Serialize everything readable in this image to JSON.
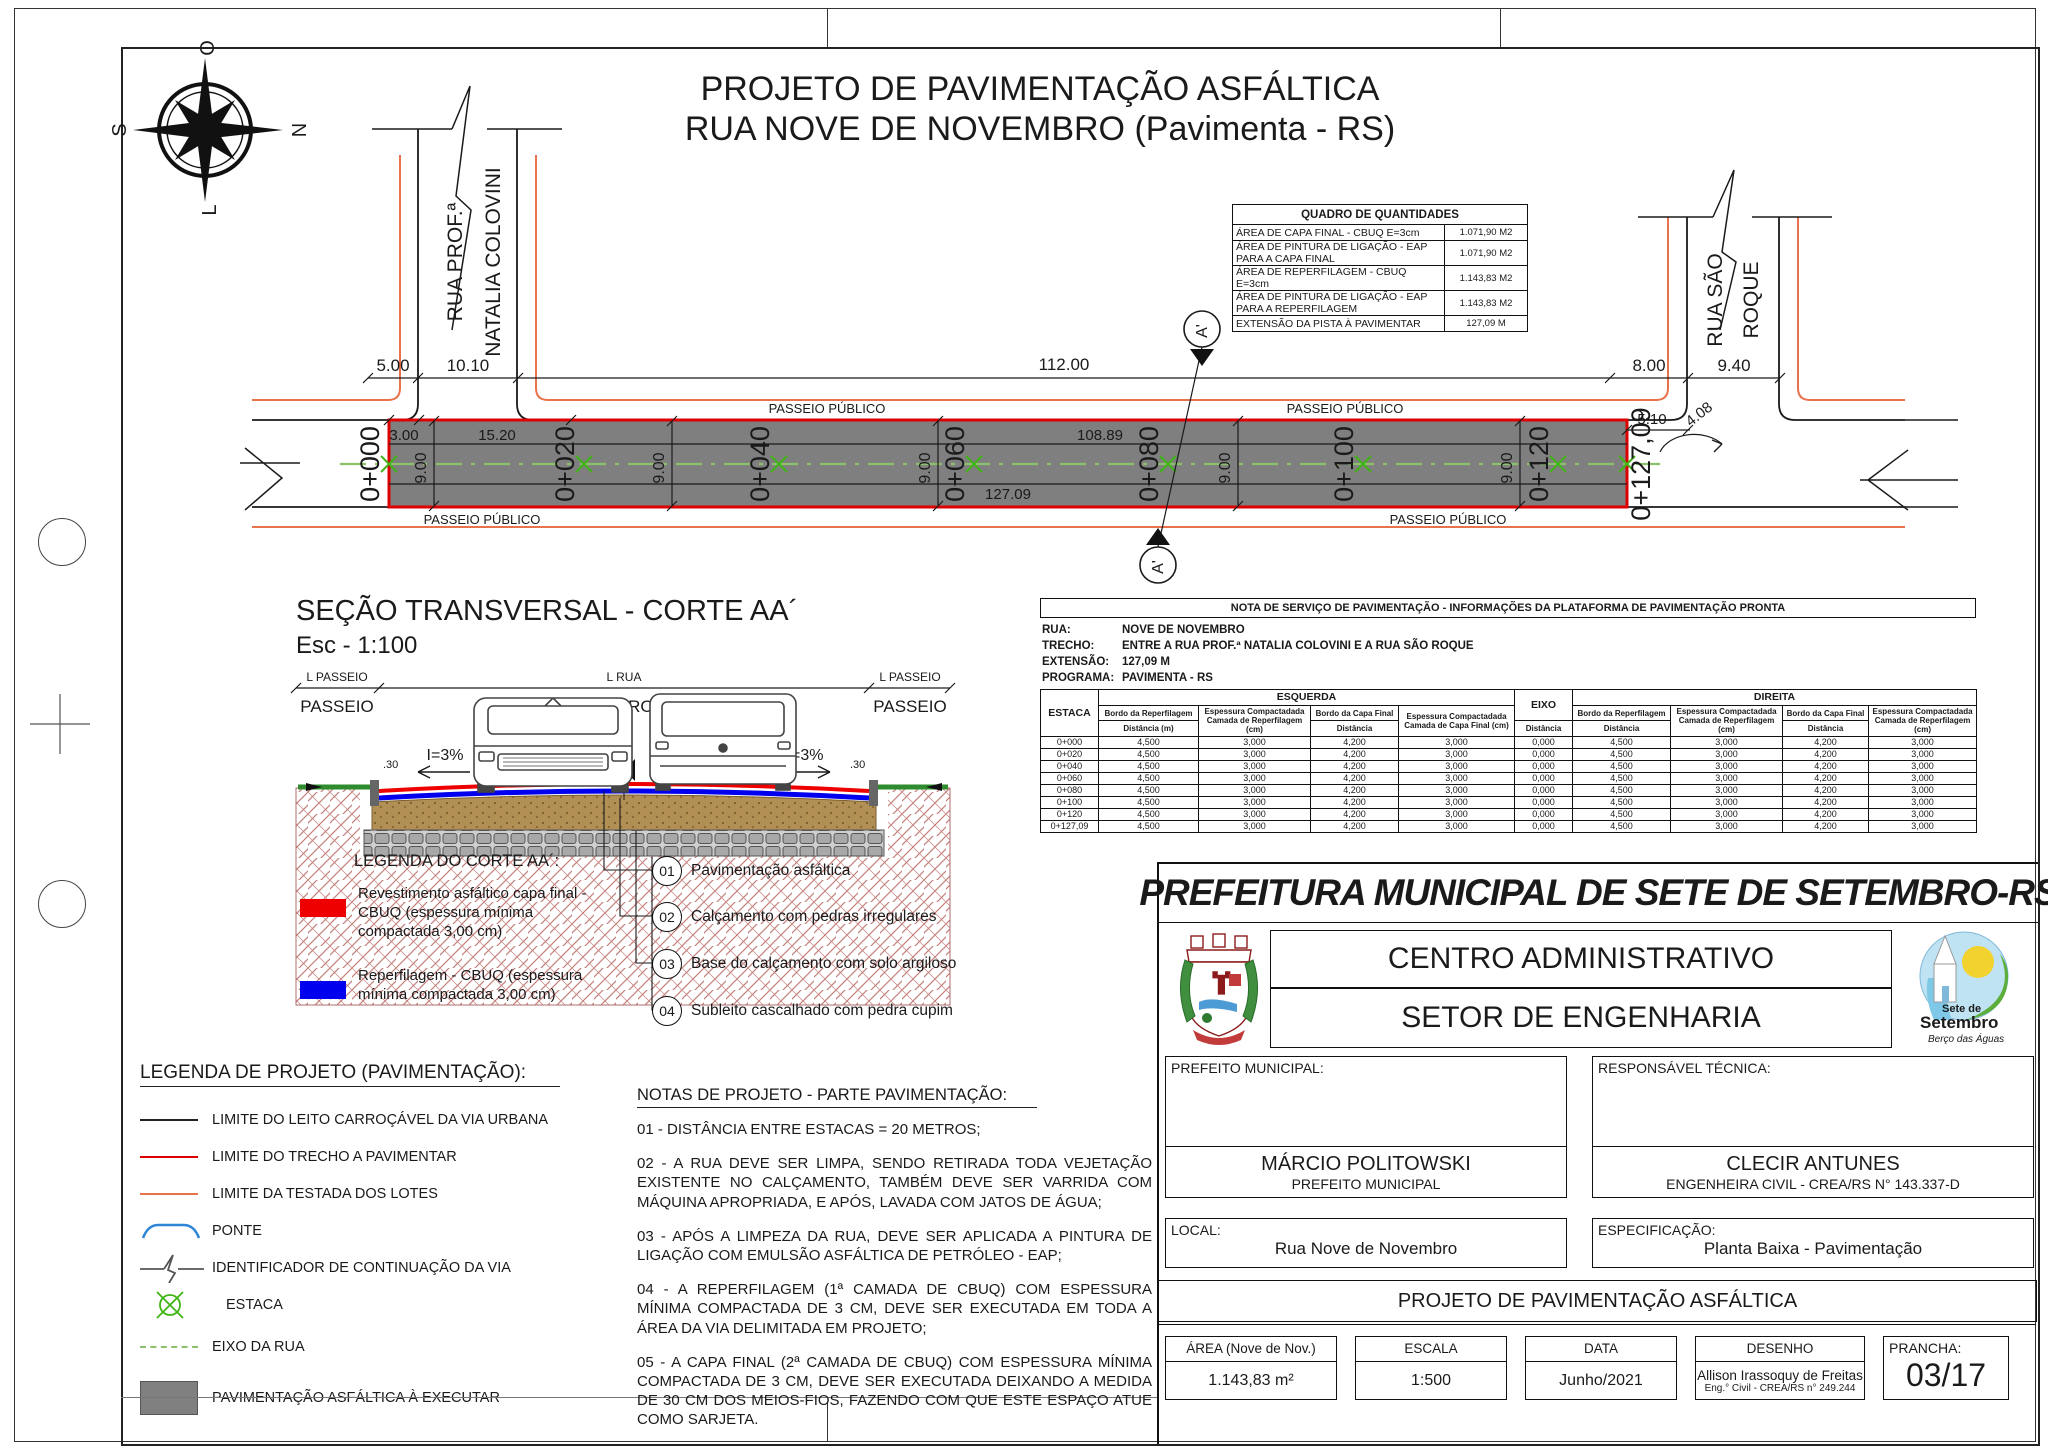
{
  "sheet": {
    "title_line1": "PROJETO DE PAVIMENTAÇÃO ASFÁLTICA",
    "title_line2": "RUA NOVE DE NOVEMBRO (Pavimenta - RS)"
  },
  "compass": {
    "n": "N",
    "s": "S",
    "o": "O",
    "l": "L"
  },
  "plan": {
    "street_left_line1": "RUA PROF.ª",
    "street_left_line2": "NATALIA COLOVINI",
    "street_right_line1": "RUA SÃO",
    "street_right_line2": "ROQUE",
    "passeio": "PASSEIO PÚBLICO",
    "stations": [
      "0+000",
      "0+020",
      "0+040",
      "0+060",
      "0+080",
      "0+100",
      "0+120",
      "0+127,09"
    ],
    "dims": {
      "d5": "5.00",
      "d1010": "10.10",
      "d112": "112.00",
      "d8": "8.00",
      "d940": "9.40",
      "d3": "3.00",
      "d1520": "15.20",
      "d10889": "108.89",
      "d12709": "127.09",
      "d510": "5.10",
      "d408": "4.08",
      "d9": "9.00"
    },
    "section_mark": "A'"
  },
  "quadro": {
    "title": "QUADRO DE QUANTIDADES",
    "rows": [
      [
        "ÁREA DE CAPA FINAL - CBUQ E=3cm",
        "1.071,90 M2"
      ],
      [
        "ÁREA DE PINTURA DE LIGAÇÃO - EAP PARA A CAPA FINAL",
        "1.071,90 M2"
      ],
      [
        "ÁREA DE REPERFILAGEM - CBUQ E=3cm",
        "1.143,83 M2"
      ],
      [
        "ÁREA DE PINTURA DE LIGAÇÃO - EAP PARA A REPERFILAGEM",
        "1.143,83 M2"
      ],
      [
        "EXTENSÃO DA PISTA À PAVIMENTAR",
        "127,09 M"
      ]
    ]
  },
  "section": {
    "title": "SEÇÃO TRANSVERSAL - CORTE AA´",
    "scale": "Esc - 1:100",
    "lim_passeio": "L PASSEIO",
    "lim_rua": "L RUA",
    "passeio": "PASSEIO",
    "leito": "LEITO CARROÇÁVEL",
    "slope": "I=3%",
    "offset": ".30",
    "eixo": "EIXO",
    "legend_title": "LEGENDA DO CORTE AA´:",
    "legend_red": "Revestimento asfáltico capa final - CBUQ (espessura mínima compactada 3,00 cm)",
    "legend_blue": "Reperfilagem - CBUQ (espessura mínima compactada 3,00 cm)",
    "callouts": [
      {
        "num": "01",
        "text": "Pavimentação asfáltica"
      },
      {
        "num": "02",
        "text": "Calçamento com pedras irregulares"
      },
      {
        "num": "03",
        "text": "Base do calçamento com solo argiloso"
      },
      {
        "num": "04",
        "text": "Subleito cascalhado com pedra cupim"
      }
    ]
  },
  "service_note": {
    "title": "NOTA DE SERVIÇO DE PAVIMENTAÇÃO - INFORMAÇÕES DA PLATAFORMA DE PAVIMENTAÇÃO PRONTA",
    "info": [
      [
        "RUA:",
        "NOVE DE NOVEMBRO"
      ],
      [
        "TRECHO:",
        "ENTRE A RUA PROF.ª NATALIA COLOVINI E A RUA SÃO ROQUE"
      ],
      [
        "EXTENSÃO:",
        "127,09 M"
      ],
      [
        "PROGRAMA:",
        "PAVIMENTA - RS"
      ]
    ],
    "headers": {
      "estaca": "ESTACA",
      "esquerda": "ESQUERDA",
      "eixo": "EIXO",
      "direita": "DIREITA",
      "bordo_rep": "Bordo da Reperfilagem",
      "dist_m": "Distância (m)",
      "esp_rep": "Espessura Compactadada Camada de Reperfilagem (cm)",
      "bordo_capa": "Bordo da Capa Final",
      "dist": "Distância",
      "esp_capa": "Espessura Compactadada Camada de Capa Final (cm)"
    },
    "rows": [
      [
        "0+000",
        "4,500",
        "3,000",
        "4,200",
        "3,000",
        "0,000",
        "4,500",
        "3,000",
        "4,200",
        "3,000"
      ],
      [
        "0+020",
        "4,500",
        "3,000",
        "4,200",
        "3,000",
        "0,000",
        "4,500",
        "3,000",
        "4,200",
        "3,000"
      ],
      [
        "0+040",
        "4,500",
        "3,000",
        "4,200",
        "3,000",
        "0,000",
        "4,500",
        "3,000",
        "4,200",
        "3,000"
      ],
      [
        "0+060",
        "4,500",
        "3,000",
        "4,200",
        "3,000",
        "0,000",
        "4,500",
        "3,000",
        "4,200",
        "3,000"
      ],
      [
        "0+080",
        "4,500",
        "3,000",
        "4,200",
        "3,000",
        "0,000",
        "4,500",
        "3,000",
        "4,200",
        "3,000"
      ],
      [
        "0+100",
        "4,500",
        "3,000",
        "4,200",
        "3,000",
        "0,000",
        "4,500",
        "3,000",
        "4,200",
        "3,000"
      ],
      [
        "0+120",
        "4,500",
        "3,000",
        "4,200",
        "3,000",
        "0,000",
        "4,500",
        "3,000",
        "4,200",
        "3,000"
      ],
      [
        "0+127,09",
        "4,500",
        "3,000",
        "4,200",
        "3,000",
        "0,000",
        "4,500",
        "3,000",
        "4,200",
        "3,000"
      ]
    ]
  },
  "legend_project": {
    "title": "LEGENDA DE PROJETO (PAVIMENTAÇÃO):",
    "items": [
      "LIMITE DO LEITO CARROÇÁVEL DA VIA URBANA",
      "LIMITE DO TRECHO A PAVIMENTAR",
      "LIMITE DA TESTADA DOS LOTES",
      "PONTE",
      "IDENTIFICADOR DE CONTINUAÇÃO DA VIA",
      "ESTACA",
      "EIXO DA RUA",
      "PAVIMENTAÇÃO ASFÁLTICA À EXECUTAR"
    ]
  },
  "notes": {
    "title": "NOTAS DE PROJETO - PARTE PAVIMENTAÇÃO:",
    "items": [
      "01 - DISTÂNCIA ENTRE ESTACAS = 20 METROS;",
      "02 - A RUA DEVE SER LIMPA, SENDO RETIRADA TODA VEJETAÇÃO EXISTENTE NO CALÇAMENTO, TAMBÉM DEVE SER VARRIDA COM MÁQUINA APROPRIADA, E APÓS, LAVADA COM JATOS DE ÁGUA;",
      "03 - APÓS A LIMPEZA DA RUA, DEVE SER APLICADA A PINTURA DE LIGAÇÃO COM EMULSÃO ASFÁLTICA DE PETRÓLEO - EAP;",
      "04 - A REPERFILAGEM (1ª CAMADA DE CBUQ) COM ESPESSURA MÍNIMA COMPACTADA DE 3 CM, DEVE SER EXECUTADA EM TODA A ÁREA DA VIA DELIMITADA EM PROJETO;",
      "05 - A CAPA FINAL (2ª CAMADA DE CBUQ) COM ESPESSURA MÍNIMA COMPACTADA DE 3 CM, DEVE SER EXECUTADA DEIXANDO A MEDIDA DE 30 CM DOS MEIOS-FIOS, FAZENDO COM QUE ESTE ESPAÇO ATUE COMO SARJETA."
    ]
  },
  "titleblock": {
    "header": "PREFEITURA MUNICIPAL DE SETE DE SETEMBRO-RS",
    "centro": "CENTRO ADMINISTRATIVO",
    "setor": "SETOR DE ENGENHARIA",
    "prefeito_label": "PREFEITO MUNICIPAL:",
    "resp_label": "RESPONSÁVEL TÉCNICA:",
    "prefeito_name": "MÁRCIO POLITOWSKI",
    "prefeito_role": "PREFEITO MUNICIPAL",
    "resp_name": "CLECIR ANTUNES",
    "resp_role": "ENGENHEIRA CIVIL - CREA/RS N° 143.337-D",
    "local_label": "LOCAL:",
    "local_value": "Rua Nove de Novembro",
    "espec_label": "ESPECIFICAÇÃO:",
    "espec_value": "Planta Baixa - Pavimentação",
    "banner": "PROJETO DE PAVIMENTAÇÃO ASFÁLTICA",
    "area_label": "ÁREA (Nove de Nov.)",
    "area_value": "1.143,83 m²",
    "escala_label": "ESCALA",
    "escala_value": "1:500",
    "data_label": "DATA",
    "data_value": "Junho/2021",
    "desenho_label": "DESENHO",
    "desenho_name": "Allison Irassoquy de Freitas",
    "desenho_sub": "Eng.° Civil - CREA/RS n° 249.244",
    "prancha_label": "PRANCHA:",
    "prancha_value": "03/17",
    "logo": {
      "name1": "Sete de",
      "name2": "Setembro",
      "tagline": "Berço das Águas"
    }
  },
  "colors": {
    "trecho_red": "#dd0000",
    "lot_orange": "#e8724c",
    "station_green": "#3fb515",
    "axis_green": "#8cc06a",
    "road_gray": "#7f7f7f",
    "bridge_blue": "#2f86d6",
    "legend_red": "#ee0000",
    "legend_blue": "#0000ee"
  }
}
